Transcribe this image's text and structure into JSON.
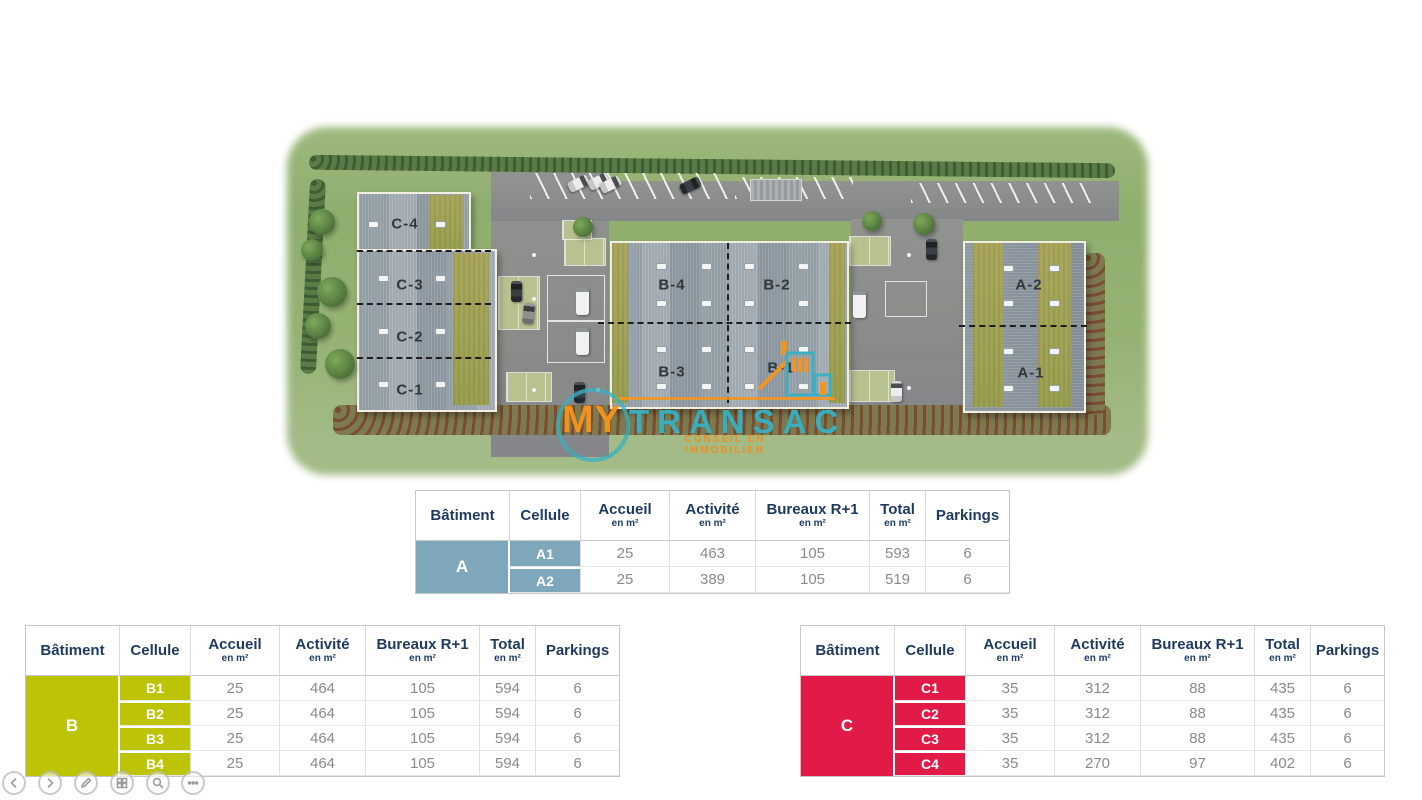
{
  "logo": {
    "word1": "MY",
    "word2": "TRANSAC",
    "tagline": "CONSEIL EN IMMOBILIER"
  },
  "plan": {
    "labels": [
      {
        "text": "C-4",
        "x": 110,
        "y": 89
      },
      {
        "text": "C-3",
        "x": 115,
        "y": 150
      },
      {
        "text": "C-2",
        "x": 115,
        "y": 202
      },
      {
        "text": "C-1",
        "x": 115,
        "y": 255
      },
      {
        "text": "B-4",
        "x": 377,
        "y": 150
      },
      {
        "text": "B-2",
        "x": 482,
        "y": 150
      },
      {
        "text": "B-3",
        "x": 377,
        "y": 237
      },
      {
        "text": "B-1",
        "x": 486,
        "y": 233
      },
      {
        "text": "A-2",
        "x": 734,
        "y": 150
      },
      {
        "text": "A-1",
        "x": 736,
        "y": 238
      }
    ]
  },
  "tables": [
    {
      "id": "A",
      "batiment": "A",
      "accent": "#7EA7BC",
      "x": 415,
      "y": 490,
      "w": 593,
      "rowH": 26,
      "headers": [
        {
          "label": "Bâtiment"
        },
        {
          "label": "Cellule"
        },
        {
          "label": "Accueil",
          "sub": "en m²"
        },
        {
          "label": "Activité",
          "sub": "en m²"
        },
        {
          "label": "Bureaux R+1",
          "sub": "en m²"
        },
        {
          "label": "Total",
          "sub": "en m²"
        },
        {
          "label": "Parkings"
        }
      ],
      "rows": [
        [
          "A1",
          "25",
          "463",
          "105",
          "593",
          "6"
        ],
        [
          "A2",
          "25",
          "389",
          "105",
          "519",
          "6"
        ]
      ]
    },
    {
      "id": "B",
      "batiment": "B",
      "accent": "#BCC405",
      "x": 25,
      "y": 625,
      "w": 593,
      "rowH": 25,
      "headers": [
        {
          "label": "Bâtiment"
        },
        {
          "label": "Cellule"
        },
        {
          "label": "Accueil",
          "sub": "en m²"
        },
        {
          "label": "Activité",
          "sub": "en m²"
        },
        {
          "label": "Bureaux R+1",
          "sub": "en m²"
        },
        {
          "label": "Total",
          "sub": "en m²"
        },
        {
          "label": "Parkings"
        }
      ],
      "rows": [
        [
          "B1",
          "25",
          "464",
          "105",
          "594",
          "6"
        ],
        [
          "B2",
          "25",
          "464",
          "105",
          "594",
          "6"
        ],
        [
          "B3",
          "25",
          "464",
          "105",
          "594",
          "6"
        ],
        [
          "B4",
          "25",
          "464",
          "105",
          "594",
          "6"
        ]
      ]
    },
    {
      "id": "C",
      "batiment": "C",
      "accent": "#E11A47",
      "x": 800,
      "y": 625,
      "w": 583,
      "rowH": 25,
      "headers": [
        {
          "label": "Bâtiment"
        },
        {
          "label": "Cellule"
        },
        {
          "label": "Accueil",
          "sub": "en m²"
        },
        {
          "label": "Activité",
          "sub": "en m²"
        },
        {
          "label": "Bureaux R+1",
          "sub": "en m²"
        },
        {
          "label": "Total",
          "sub": "en m²"
        },
        {
          "label": "Parkings"
        }
      ],
      "rows": [
        [
          "C1",
          "35",
          "312",
          "88",
          "435",
          "6"
        ],
        [
          "C2",
          "35",
          "312",
          "88",
          "435",
          "6"
        ],
        [
          "C3",
          "35",
          "312",
          "88",
          "435",
          "6"
        ],
        [
          "C4",
          "35",
          "270",
          "97",
          "402",
          "6"
        ]
      ]
    }
  ],
  "colors": {
    "batA": "#7EA7BC",
    "batB": "#BCC405",
    "batC": "#E11A47",
    "logoOrange": "#F7941D",
    "logoTeal": "#38B0C2",
    "headerText": "#1F3A5F",
    "valueText": "#8A8A8A"
  }
}
